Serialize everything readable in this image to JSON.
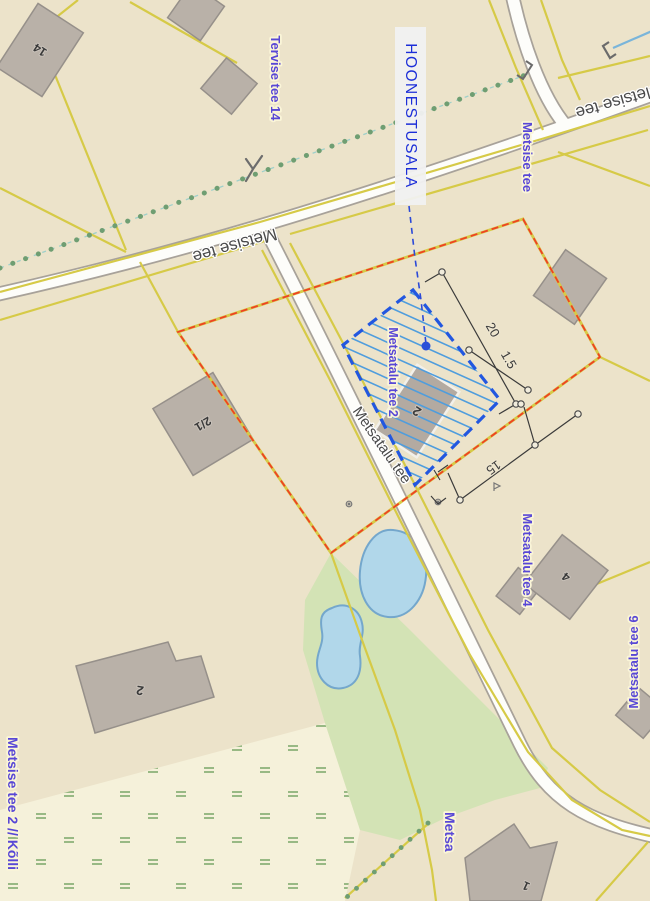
{
  "map": {
    "area_label": "HOONESTUSALA",
    "labels": {
      "tervise_tee_14": "Tervise tee 14",
      "metsise_tee": "Metsise tee",
      "metsise_tee_right": "Metsise tee",
      "metsise_tee_branch": "Metsise tee",
      "metsatalu_tee_road": "Metsatalu tee",
      "metsatalu_tee_2": "Metsatalu tee 2",
      "metsatalu_tee_4": "Metsatalu tee 4",
      "metsatalu_tee_6": "Metsatalu tee 6",
      "metsise_tee_2_kolli": "Metsise tee 2 // Kõlli",
      "metsatalu_tee_bottom": "Metsa"
    },
    "building_numbers": {
      "b14": "14",
      "b2_1": "2/1",
      "b2_site": "2",
      "b2_south": "2",
      "b4": "4",
      "b1": "1"
    },
    "dimensions": {
      "length": "20",
      "width": "1.5",
      "side": "15"
    },
    "colors": {
      "land": "#ece3ca",
      "wetland": "#f5f1da",
      "green_area": "#d3e3b5",
      "pond_fill": "#b1d7ea",
      "pond_edge": "#74a7cc",
      "road_fill": "#fdfdfa",
      "road_casing": "#a8a29a",
      "parcel_line": "#d6ca47",
      "boundary_dash": "#ef4123",
      "hoonestusala_blue": "#2257e0",
      "hatch_blue": "#4f9ddd",
      "address_label": "#5847d6",
      "area_label": "#1c2ed8",
      "building_fill": "#b9b1a8",
      "tree_dot_green": "#6f9e72"
    }
  }
}
